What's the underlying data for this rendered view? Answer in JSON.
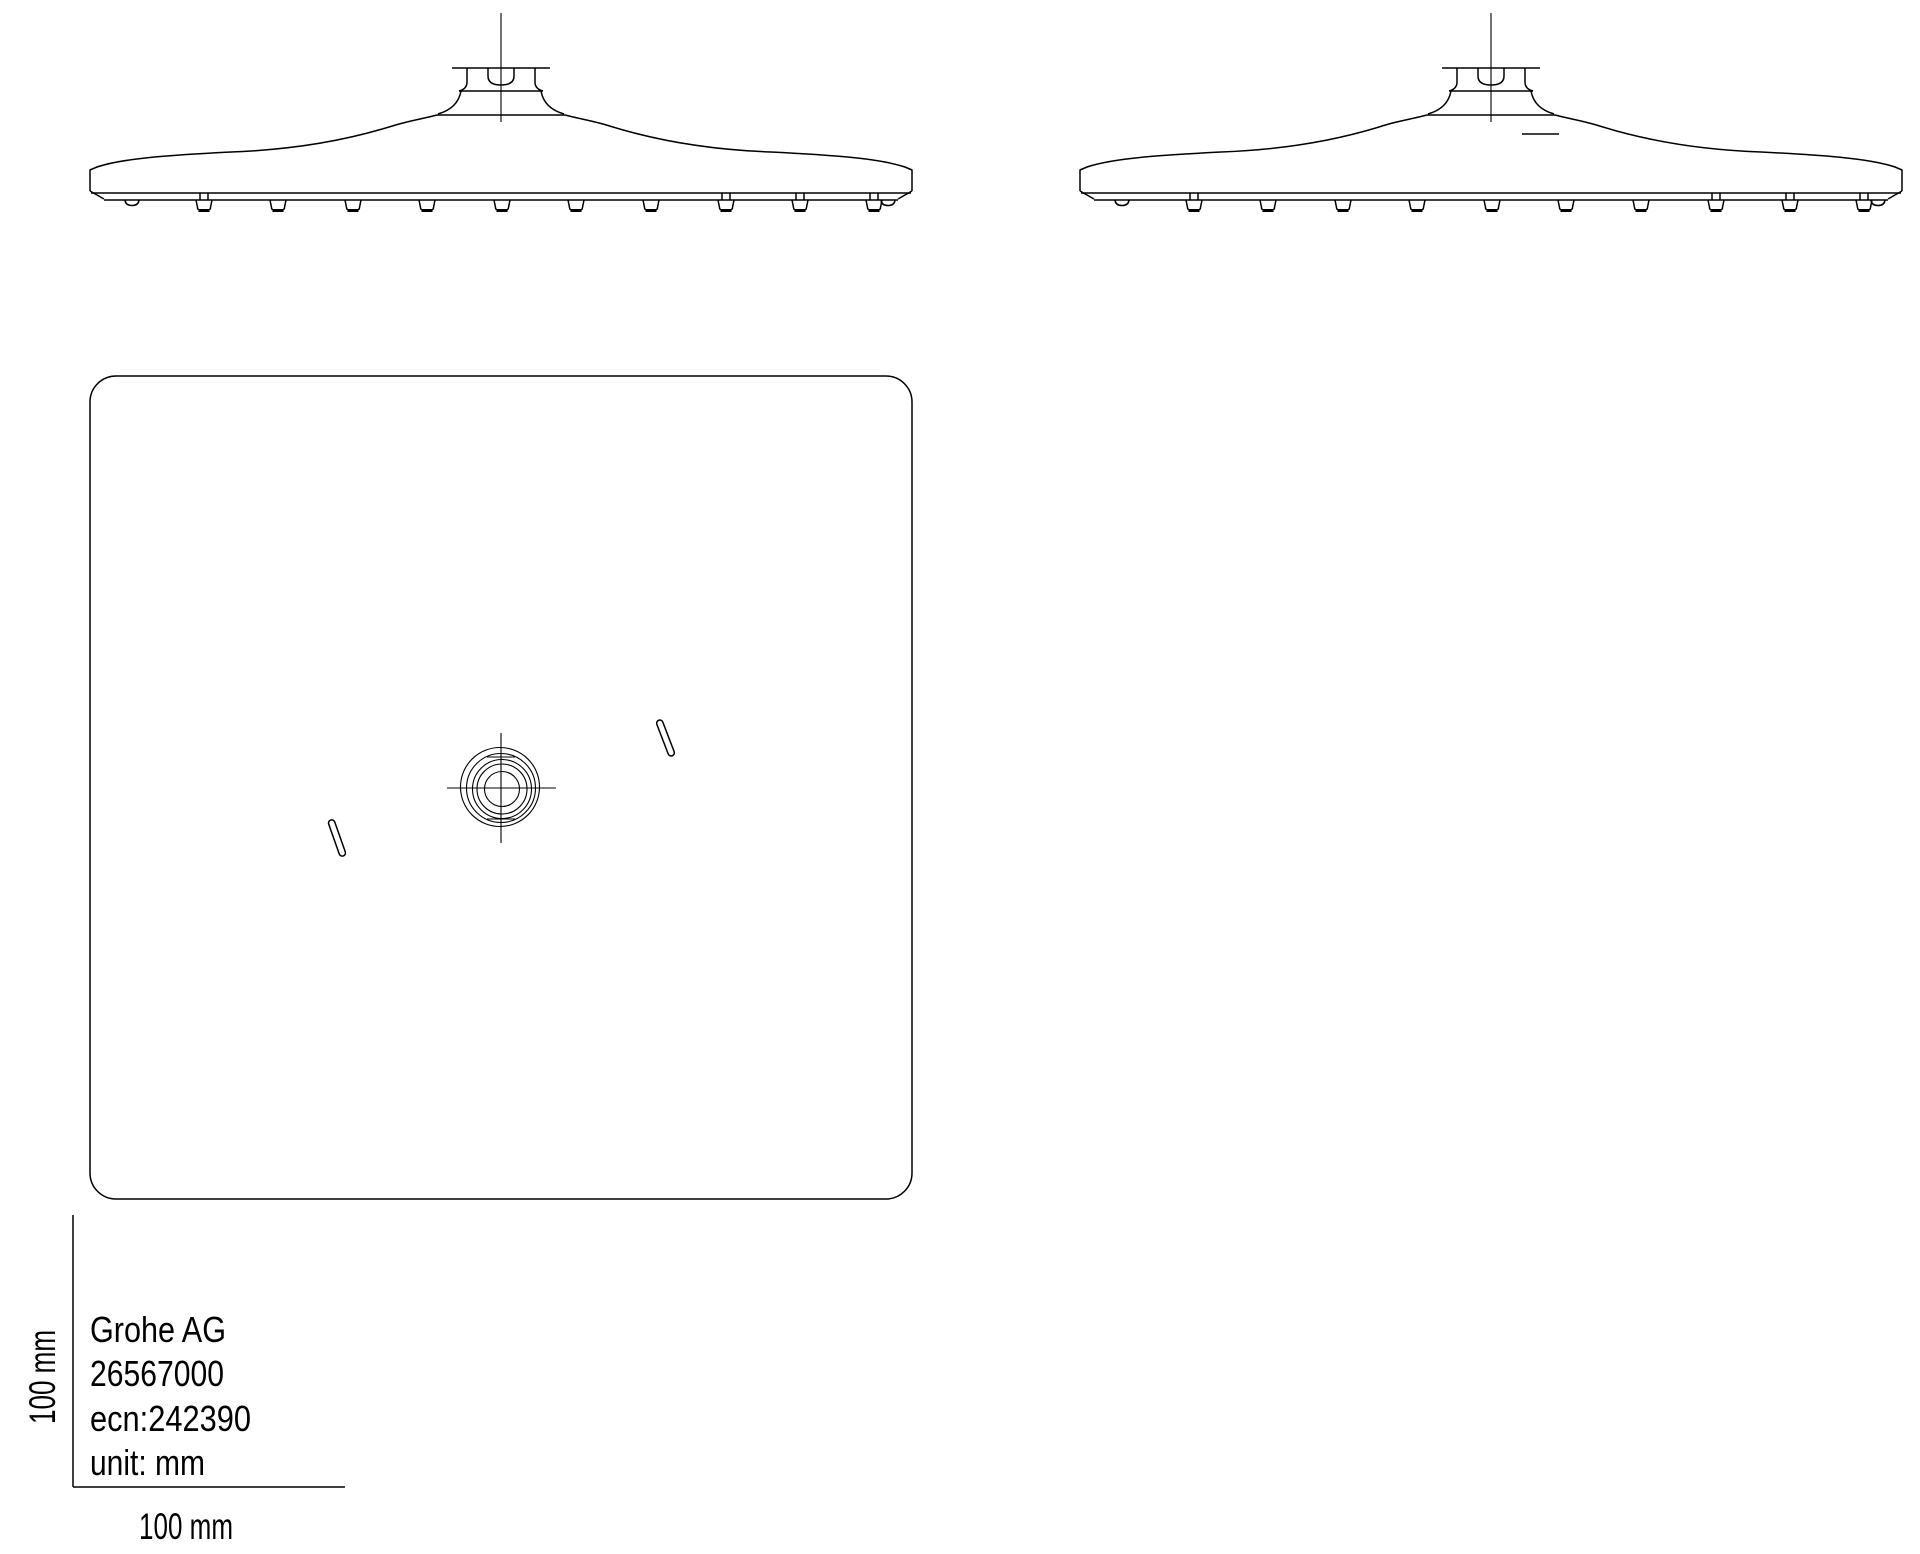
{
  "page": {
    "background_color": "#ffffff",
    "line_color": "#000000"
  },
  "title_block": {
    "company": "Grohe AG",
    "product_number": "26567000",
    "ecn": "ecn:242390",
    "unit": "unit: mm"
  },
  "scale_bar": {
    "vertical_label": "100 mm",
    "horizontal_label": "100 mm"
  }
}
